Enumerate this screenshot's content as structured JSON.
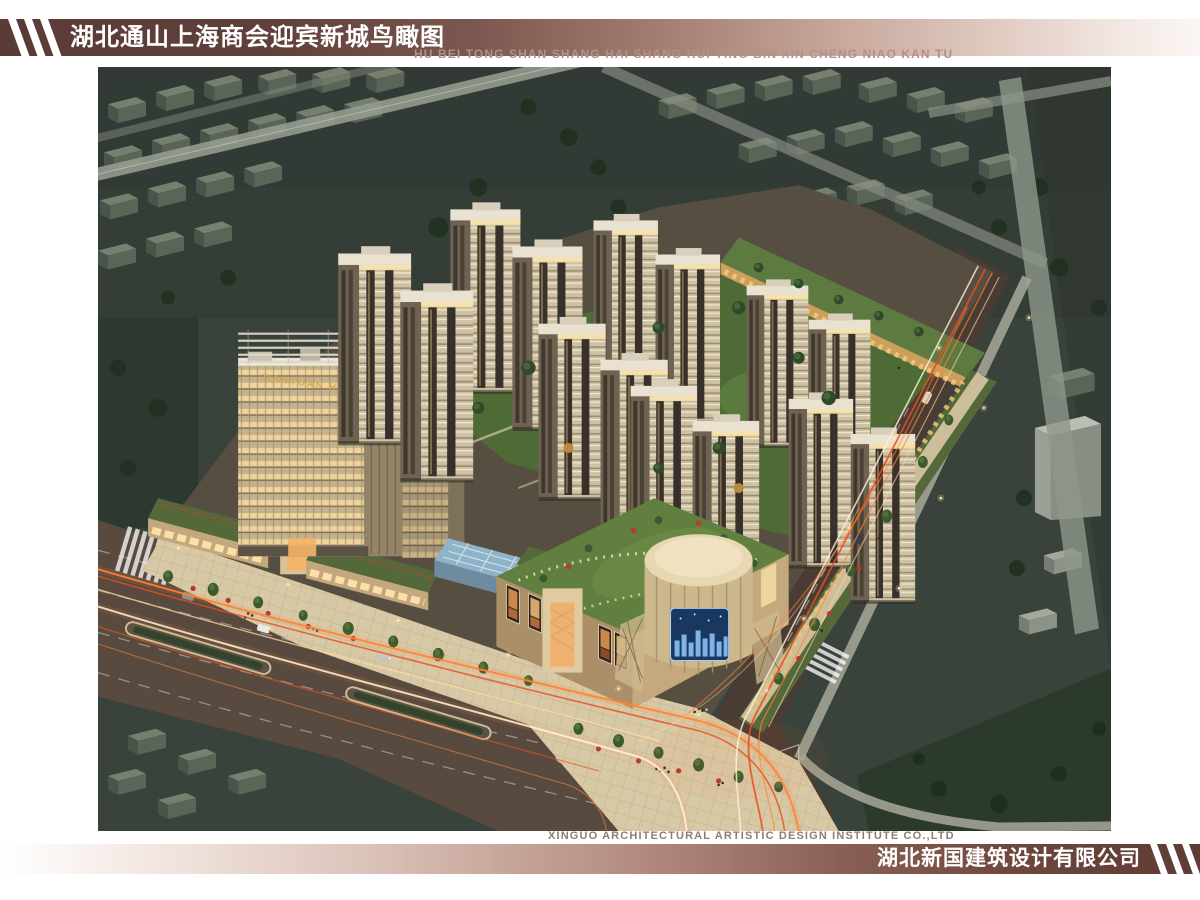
{
  "header": {
    "title_cn": "湖北通山上海商会迎宾新城鸟瞰图",
    "subtitle_pinyin": "HU BEI TONG SHAN SHANG HAI SHANG HUI YING BIN XIN CHENG NIAO KAN TU"
  },
  "rendering": {
    "hotel_sign": "JIANYUAN HOTEL"
  },
  "footer": {
    "credit_en": "XINGUO ARCHITECTURAL ARTISTIC DESIGN INSTITUTE CO.,LTD",
    "company_cn": "湖北新国建筑设计有限公司"
  },
  "colors": {
    "band_dark_top": "#5a3b35",
    "band_dark_bottom": "#5e3c34",
    "pinyin": "#b5908a",
    "credit": "#8e7d74",
    "sign_gold": "#d9a84e",
    "trail_orange": "#ff7e2e",
    "grass_roof": "#5f7c3e",
    "plaza_paving": "#d8c9a6"
  }
}
